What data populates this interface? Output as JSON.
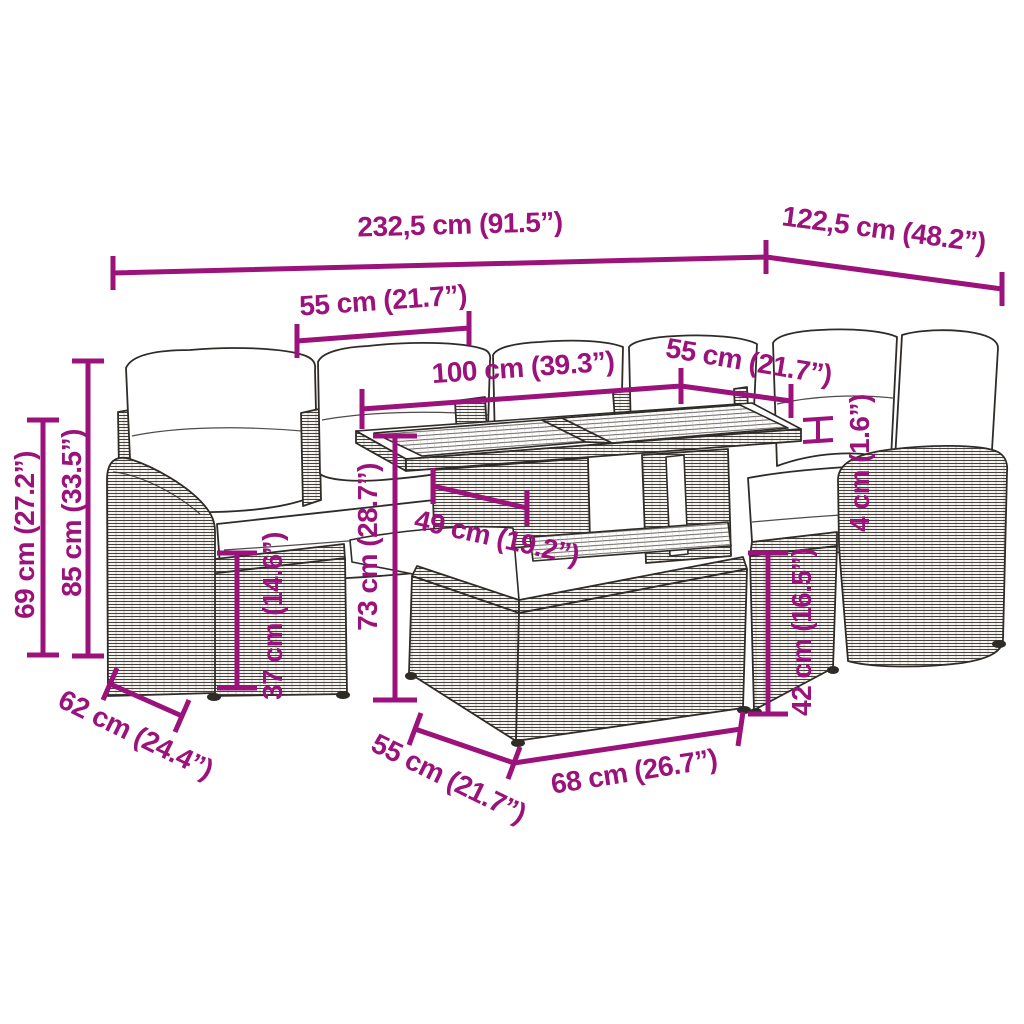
{
  "diagram": {
    "title": "Rattan garden lounge set with table - dimension diagram",
    "accent_color": "#9B127B",
    "outline_color": "#2F2C28",
    "dims": {
      "overall_width": {
        "label": "232,5 cm (91.5”)"
      },
      "overall_depth": {
        "label": "122,5 cm (48.2”)"
      },
      "seat_width_left": {
        "label": "55 cm (21.7”)"
      },
      "table_length": {
        "label": "100 cm (39.3”)"
      },
      "seat_width_right": {
        "label": "55 cm (21.7”)"
      },
      "tabletop_thickness": {
        "label": "4 cm (1.6”)"
      },
      "seat_height_right": {
        "label": "42 cm (16.5”)"
      },
      "seat_height_left": {
        "label": "37 cm (14.6”)"
      },
      "table_height": {
        "label": "73 cm (28.7”)"
      },
      "table_clearance": {
        "label": "49 cm (19.2”)"
      },
      "back_height": {
        "label": "85 cm (33.5”)"
      },
      "arm_height": {
        "label": "69 cm (27.2”)"
      },
      "seat_depth_left": {
        "label": "62 cm (24.4”)"
      },
      "stool_depth": {
        "label": "55 cm (21.7”)"
      },
      "stool_width": {
        "label": "68 cm (26.7”)"
      }
    }
  }
}
